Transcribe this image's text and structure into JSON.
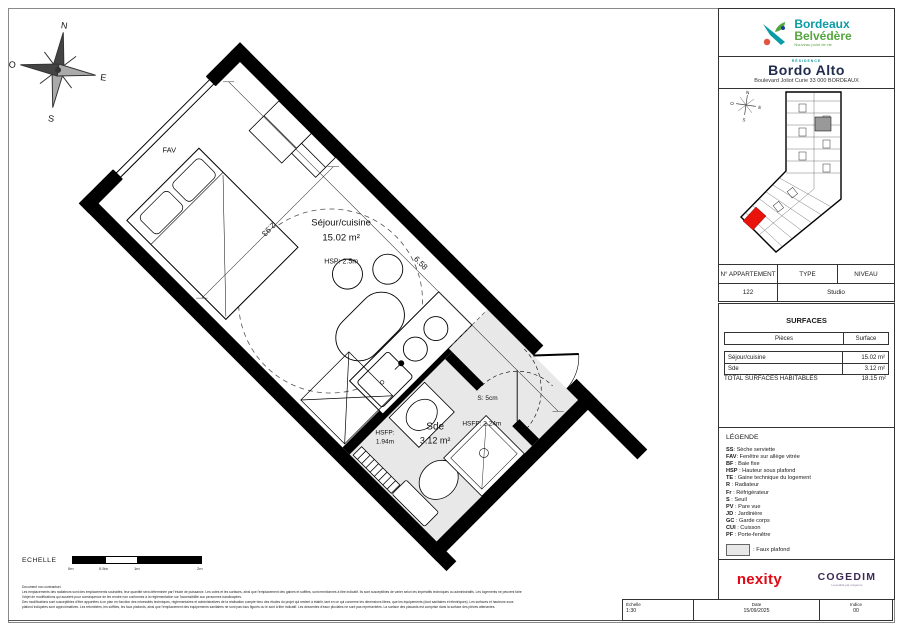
{
  "colors": {
    "brand_teal": "#0b9ba5",
    "brand_green": "#55a63f",
    "brand_red": "#e2543e",
    "residence_navy": "#222c4e",
    "nexity_red": "#e00814",
    "cogedim_purple": "#3f2a56",
    "highlight_unit_red": "#e8140c",
    "faux_plafond_gray": "#e8e8e8"
  },
  "plan": {
    "compass": {
      "n": "N",
      "s": "S",
      "e": "E",
      "o": "O"
    },
    "labels": {
      "fav": "FAV",
      "sejour_name": "Séjour/cuisine",
      "sejour_area": "15.02 m²",
      "sejour_hsp": "HSP: 2.5m",
      "sde_name": "Sde",
      "sde_area": "3.12 m²",
      "hsfp1_l1": "HSFP:",
      "hsfp1_l2": "1.94m",
      "seuil": "S: 5cm",
      "hsfp2": "HSFP: 2.24m",
      "dim_width": "2.93",
      "dim_length": "6.58"
    },
    "scalebar": {
      "label": "ECHELLE",
      "ticks": [
        "0m",
        "0.5m",
        "1m",
        "2m"
      ]
    }
  },
  "sidebar": {
    "brand": {
      "line1": "Bordeaux",
      "line2": "Belvédère",
      "tagline": "Nouveau point de vie"
    },
    "residence": {
      "pre": "RÉSIDENCE",
      "name": "Bordo Alto",
      "address": "Boulevard Joliot Curie 33 000 BORDEAUX"
    },
    "apartment": {
      "col_number": "N° APPARTEMENT",
      "col_type": "TYPE",
      "col_level": "NIVEAU",
      "number": "122",
      "type": "Studio"
    },
    "surfaces": {
      "title": "SURFACES",
      "col_piece": "Pièces",
      "col_surface": "Surface",
      "rows": [
        {
          "piece": "Séjour/cuisine",
          "surface": "15.02 m²"
        },
        {
          "piece": "Sde",
          "surface": "3.12 m²"
        }
      ],
      "total_label": "TOTAL SURFACES HABITABLES",
      "total_value": "18.15 m²"
    },
    "legend": {
      "title": "LÉGENDE",
      "items": [
        {
          "abbr": "SS",
          "desc": ": Sèche serviette"
        },
        {
          "abbr": "FAV",
          "desc": ": Fenêtre sur allège vitrée"
        },
        {
          "abbr": "BF",
          "desc": " : Baie fixe"
        },
        {
          "abbr": "HSP",
          "desc": " : Hauteur sous plafond"
        },
        {
          "abbr": "TE",
          "desc": " : Gaine technique du logement"
        },
        {
          "abbr": "R",
          "desc": " : Radiateur"
        },
        {
          "abbr": "Fr",
          "desc": " : Réfrigérateur"
        },
        {
          "abbr": "S",
          "desc": " : Seuil"
        },
        {
          "abbr": "PV",
          "desc": " : Pare vue"
        },
        {
          "abbr": "JD",
          "desc": " : Jardinière"
        },
        {
          "abbr": "GC",
          "desc": " : Garde corps"
        },
        {
          "abbr": "CUI",
          "desc": " : Cuisson"
        },
        {
          "abbr": "PF",
          "desc": " : Porte-fenêtre"
        }
      ],
      "faux_plafond": ": Faux plafond"
    },
    "developers": {
      "nexity": "nexity",
      "cogedim": "COGEDIM",
      "cogedim_tagline": "La qualité par exigence"
    },
    "footer": {
      "echelle_label": "Échelle",
      "echelle_value": "1:30",
      "date_label": "Date",
      "date_value": "15/09/2025",
      "indice_label": "Indice",
      "indice_value": "00"
    }
  },
  "disclaimer": {
    "line0": "Document non contractuel.",
    "line1": "Les emplacements des radiateurs sont des emplacements souhaités, leur quantité sera déterminée par l'étude de puissance. Les cotes et les surfaces, ainsi que l'emplacement des gaines et soffites, sont mentionnés à titre indicatif. Ils sont susceptibles de varier selon les impératifs techniques ou administratifs. Les logements ne peuvent faire",
    "line2": "l'objet de modifications qui auraient pour conséquence de les rendre non conformes à la réglementation sur l'accessibilité aux personnes handicapées.",
    "line3": "Des modifications sont susceptibles d'être apportées à ce plan en fonction des nécessités techniques, réglementaires et administratives de la réalisation compte tenu des études du projet qui restent à établir, tant en ce qui concerne les dimensions libres, que les équipements (dont sanitaires et électriques). Les surfaces et hauteurs sous",
    "line4": "plafond indiquées sont approximatives. Les retombées, les soffites, les faux plafonds, ainsi que l'emplacement des équipements sanitaires ne sont pas tous figurés ou le sont à titre indicatif. Les descentes d'eaux pluviales ne sont pas représentées. La surface des placards est comprise dans la surface des pièces attenantes."
  }
}
